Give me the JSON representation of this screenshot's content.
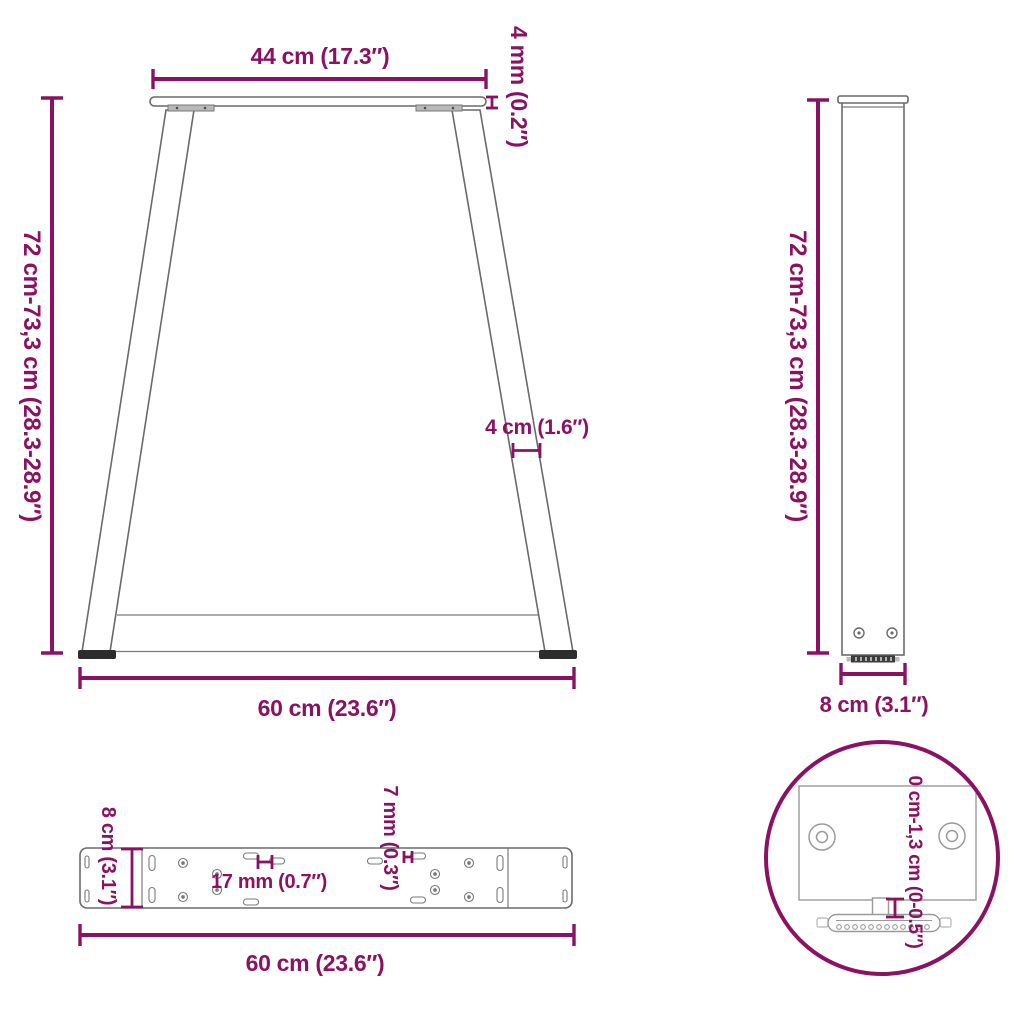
{
  "colors": {
    "dimension": "#8B1262",
    "linework": "#6a6a6a",
    "foot_dark": "#2d2d2d",
    "background": "#ffffff"
  },
  "views": {
    "front": {
      "dims": {
        "top_width": "44 cm (17.3″)",
        "plate_thickness": "4 mm (0.2″)",
        "height": "72 cm-73,3 cm (28.3-28.9″)",
        "leg_width": "4 cm (1.6″)",
        "bottom_width": "60 cm (23.6″)"
      }
    },
    "side": {
      "dims": {
        "height": "72 cm-73,3 cm (28.3-28.9″)",
        "width": "8 cm (3.1″)"
      }
    },
    "top": {
      "dims": {
        "depth": "8 cm (3.1″)",
        "hole_diameter": "17 mm (0.7″)",
        "slot_width": "7 mm (0.3″)",
        "length": "60 cm (23.6″)"
      }
    },
    "detail": {
      "dims": {
        "adjustment_range": "0 cm-1,3 cm (0-0.5″)"
      }
    }
  }
}
